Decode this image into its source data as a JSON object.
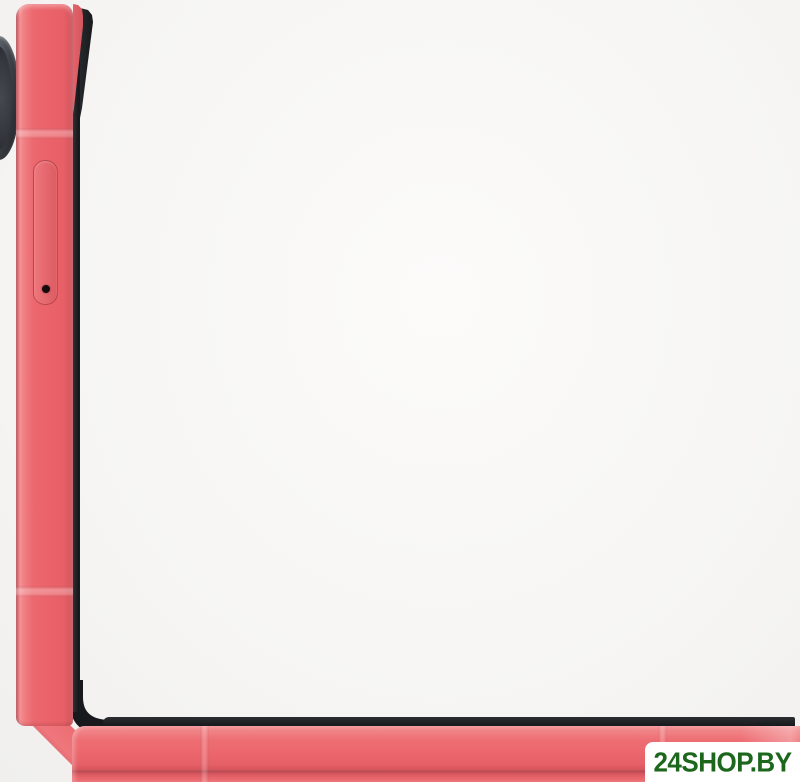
{
  "image": {
    "description": "Coral pink flip smartphone shown half-open (90 degrees) in side profile, forming an L shape; camera bump at top, SIM tray on side frame, dark screen edges facing inward"
  },
  "watermark": {
    "text": "24SHOP.BY"
  },
  "colors": {
    "background": "#f6f5f3",
    "frame_coral": "#ec686e",
    "frame_coral_light": "#f49295",
    "frame_coral_dark": "#d5575f",
    "frame_coral_deep": "#b44a52",
    "screen_edge_black": "#17191c",
    "camera_ring_gray": "#8b9198",
    "camera_lens_dark": "#33373d",
    "watermark_bg": "#ffffff",
    "watermark_green": "#1d671d"
  }
}
